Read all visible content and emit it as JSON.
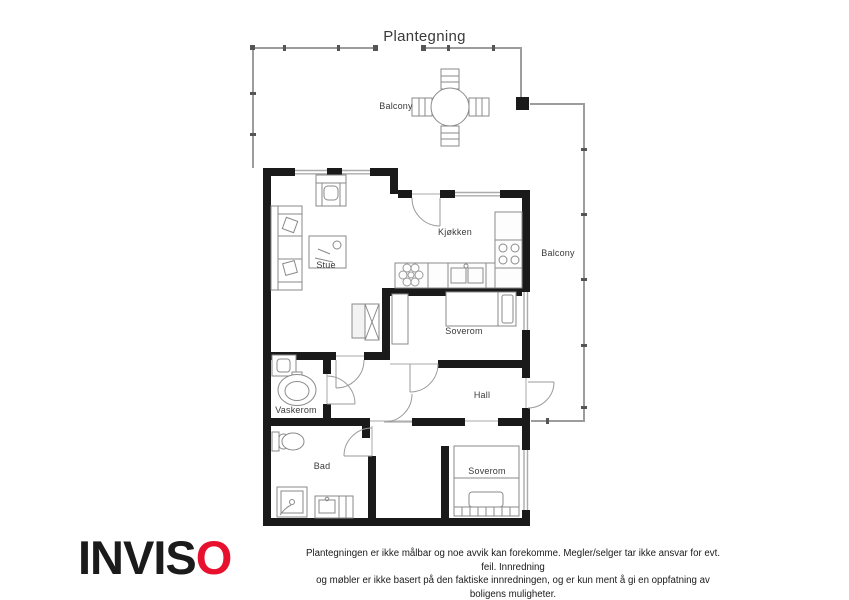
{
  "title": "Plantegning",
  "plan": {
    "labels": {
      "balcony_top": "Balcony",
      "balcony_right": "Balcony",
      "kitchen": "Kjøkken",
      "living_room": "Stue",
      "bedroom_mid": "Soverom",
      "hall": "Hall",
      "laundry": "Vaskerom",
      "bathroom": "Bad",
      "bedroom_bottom": "Soverom"
    }
  },
  "footer": {
    "logo_black": "INVIS",
    "logo_red": "O",
    "disclaimer_line1": "Plantegningen er ikke målbar og noe avvik kan forekomme. Megler/selger tar ikke ansvar for evt. feil. Innredning",
    "disclaimer_line2": "og møbler er ikke basert på den faktiske innredningen, og er kun ment å gi en oppfatning av boligens muligheter."
  },
  "colors": {
    "logo_red": "#e8112d",
    "wall_black": "#1a1a1a",
    "railing_gray": "#9c9c9c"
  }
}
